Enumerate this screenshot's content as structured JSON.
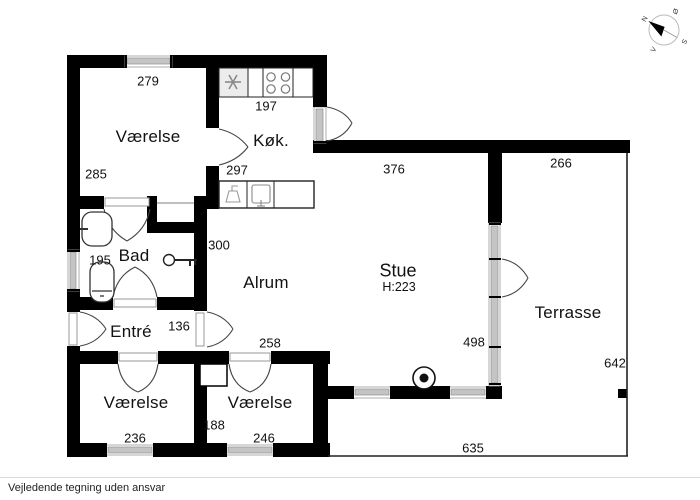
{
  "footer": {
    "disclaimer": "Vejledende tegning uden ansvar"
  },
  "compass": {
    "n": "N",
    "e": "Ø",
    "s": "S",
    "w": "V"
  },
  "rooms": {
    "vaerelse_tl": "Værelse",
    "koekken": "Køk.",
    "bad": "Bad",
    "entre": "Entré",
    "alrum": "Alrum",
    "stue": "Stue",
    "stue_height": "H:223",
    "terrasse": "Terrasse",
    "vaerelse_bl": "Værelse",
    "vaerelse_br": "Værelse"
  },
  "dims": {
    "d279": "279",
    "d285": "285",
    "d197": "197",
    "d297": "297",
    "d300": "300",
    "d195": "195",
    "d136": "136",
    "d258": "258",
    "d376": "376",
    "d266": "266",
    "d498": "498",
    "d642": "642",
    "d236": "236",
    "d188": "188",
    "d246": "246",
    "d635": "635"
  },
  "icons": {
    "compass": "compass-rose",
    "fridge": "snowflake",
    "stove": "four-burners",
    "wood_stove": "circle-dot",
    "entrance": "key"
  },
  "palette": {
    "wall": "#000000",
    "window_glass": "#c4c4c4",
    "door_line": "#444444",
    "background": "#ffffff"
  }
}
